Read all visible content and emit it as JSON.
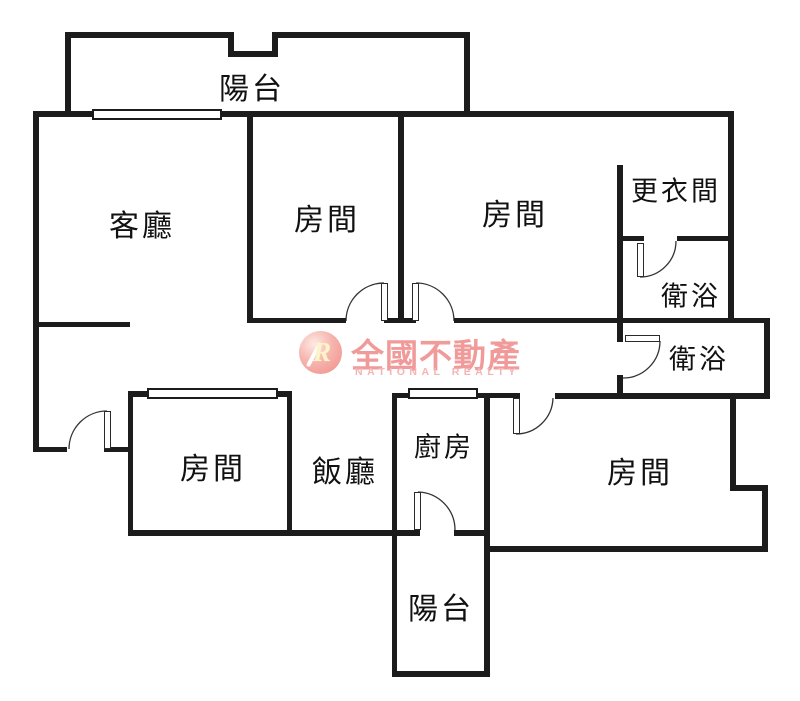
{
  "watermark": {
    "cjk": "全國不動產",
    "en": "NATIONAL REALTY",
    "logo_letter": "R",
    "pink": "#f09a9a",
    "pink_light": "#f4b4b4"
  },
  "colors": {
    "wall": "#1c1c1c",
    "label": "#111111",
    "background": "#ffffff"
  },
  "floorplan": {
    "width": 800,
    "height": 701,
    "rooms": [
      {
        "id": "balcony-top",
        "label": "陽台",
        "cx": 252,
        "cy": 86,
        "size": 30
      },
      {
        "id": "living-room",
        "label": "客廳",
        "cx": 142,
        "cy": 223,
        "size": 30
      },
      {
        "id": "bedroom-top-1",
        "label": "房間",
        "cx": 327,
        "cy": 217,
        "size": 30
      },
      {
        "id": "bedroom-top-2",
        "label": "房間",
        "cx": 515,
        "cy": 212,
        "size": 30
      },
      {
        "id": "dressing-room",
        "label": "更衣間",
        "cx": 676,
        "cy": 189,
        "size": 27
      },
      {
        "id": "bathroom-1",
        "label": "衛浴",
        "cx": 691,
        "cy": 294,
        "size": 27
      },
      {
        "id": "bathroom-2",
        "label": "衛浴",
        "cx": 699,
        "cy": 357,
        "size": 27
      },
      {
        "id": "bedroom-left",
        "label": "房間",
        "cx": 213,
        "cy": 466,
        "size": 30
      },
      {
        "id": "dining-room",
        "label": "飯廳",
        "cx": 345,
        "cy": 469,
        "size": 30
      },
      {
        "id": "kitchen",
        "label": "廚房",
        "cx": 444,
        "cy": 445,
        "size": 27
      },
      {
        "id": "bedroom-right",
        "label": "房間",
        "cx": 640,
        "cy": 470,
        "size": 30
      },
      {
        "id": "balcony-bottom",
        "label": "陽台",
        "cx": 441,
        "cy": 606,
        "size": 30
      }
    ],
    "walls": [
      [
        65,
        32,
        168,
        6
      ],
      [
        228,
        32,
        6,
        25
      ],
      [
        228,
        51,
        50,
        6
      ],
      [
        272,
        32,
        6,
        25
      ],
      [
        272,
        32,
        198,
        6
      ],
      [
        65,
        32,
        6,
        80
      ],
      [
        464,
        32,
        6,
        80
      ],
      [
        33,
        111,
        701,
        6
      ],
      [
        33,
        111,
        6,
        341
      ],
      [
        33,
        322,
        97,
        5
      ],
      [
        247,
        111,
        6,
        212
      ],
      [
        398,
        111,
        6,
        212
      ],
      [
        247,
        318,
        99,
        5
      ],
      [
        384,
        318,
        32,
        5
      ],
      [
        454,
        318,
        316,
        5
      ],
      [
        728,
        111,
        6,
        212
      ],
      [
        617,
        165,
        6,
        177
      ],
      [
        617,
        375,
        6,
        24
      ],
      [
        617,
        236,
        27,
        5
      ],
      [
        677,
        236,
        57,
        5
      ],
      [
        764,
        322,
        6,
        77
      ],
      [
        555,
        393,
        215,
        6
      ],
      [
        392,
        393,
        128,
        5
      ],
      [
        392,
        393,
        5,
        284
      ],
      [
        484,
        393,
        6,
        284
      ],
      [
        128,
        391,
        164,
        6
      ],
      [
        128,
        391,
        5,
        144
      ],
      [
        287,
        391,
        5,
        144
      ],
      [
        128,
        530,
        292,
        6
      ],
      [
        454,
        530,
        33,
        6
      ],
      [
        33,
        447,
        34,
        5
      ],
      [
        104,
        447,
        26,
        5
      ],
      [
        730,
        397,
        6,
        91
      ],
      [
        730,
        485,
        38,
        6
      ],
      [
        762,
        485,
        6,
        67
      ],
      [
        484,
        546,
        284,
        6
      ],
      [
        392,
        671,
        98,
        6
      ]
    ],
    "windows": [
      [
        92,
        109,
        130,
        11
      ],
      [
        147,
        388,
        131,
        11
      ],
      [
        408,
        388,
        70,
        11
      ]
    ],
    "door_panels": [
      [
        381,
        283,
        7,
        38
      ],
      [
        412,
        283,
        7,
        38
      ],
      [
        637,
        243,
        7,
        34
      ],
      [
        625,
        335,
        35,
        7
      ],
      [
        513,
        398,
        7,
        36
      ],
      [
        414,
        492,
        7,
        38
      ],
      [
        104,
        411,
        7,
        38
      ]
    ],
    "door_arcs": [
      {
        "path": "M 346 321 A 38 38 0 0 1 384 283"
      },
      {
        "path": "M 416 283 A 38 38 0 0 1 454 321"
      },
      {
        "path": "M 640 277 A 36 36 0 0 0 676 241"
      },
      {
        "path": "M 660 341 A 37 37 0 0 1 623 378"
      },
      {
        "path": "M 516 434 A 37 37 0 0 0 553 398"
      },
      {
        "path": "M 418 492 A 38 38 0 0 1 455 530"
      },
      {
        "path": "M 69 449 A 38 38 0 0 1 107 411"
      }
    ]
  }
}
